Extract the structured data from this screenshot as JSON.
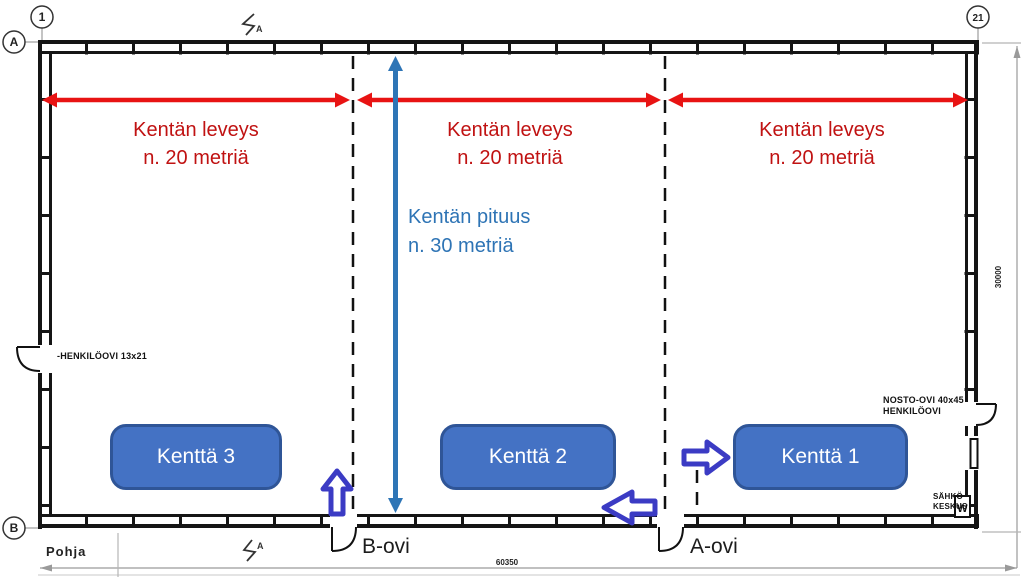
{
  "plan": {
    "sheet_label": "Pohja",
    "grid_markers": {
      "col_left": "1",
      "col_right": "21",
      "row_top": "A",
      "row_bottom": "B",
      "section_top": "A",
      "section_bottom": "A"
    },
    "dimensions": {
      "width_mm": "60350",
      "height_mm": "30000"
    },
    "doors": {
      "door_b": "B-ovi",
      "door_a": "A-ovi",
      "person_door_left": "-HENKILÖOVI 13x21",
      "lift_door_line1": "NOSTO-OVI 40x45",
      "lift_door_line2": "HENKILÖOVI",
      "electric_line1": "SÄHKÖ",
      "electric_line2": "KESKUS",
      "electric_symbol": "W"
    }
  },
  "annotations": {
    "field_width_line1": "Kentän leveys",
    "field_width_line2": "n. 20 metriä",
    "field_length_line1": "Kentän pituus",
    "field_length_line2": "n. 30 metriä",
    "colors": {
      "red_arrow": "#e81313",
      "red_text": "#c01212",
      "blue_arrow": "#2e75b6",
      "blue_text": "#2e74b5",
      "outline_arrow_border": "#3b3bc4",
      "field_fill": "#4472c4",
      "field_border": "#2f5597"
    }
  },
  "fields": [
    {
      "label": "Kenttä 1"
    },
    {
      "label": "Kenttä 2"
    },
    {
      "label": "Kenttä 3"
    }
  ]
}
